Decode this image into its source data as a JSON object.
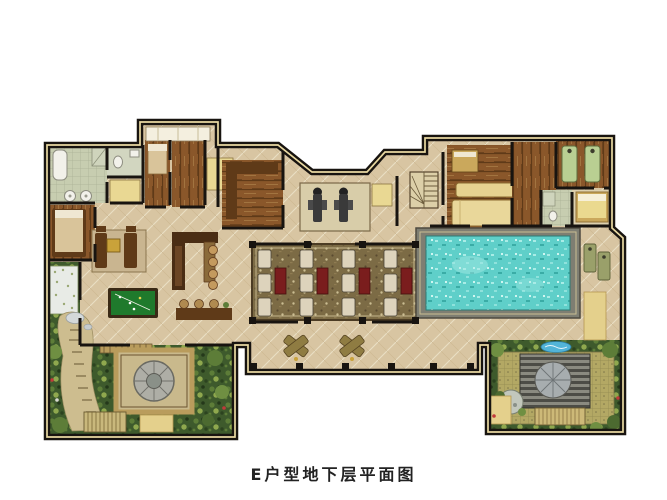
{
  "caption": "E户型地下层平面图",
  "plan": {
    "features": [
      "building-outline",
      "lightwell-notch",
      "bathroom",
      "toilet-room",
      "shower",
      "closet-rooms",
      "bedroom-left",
      "lounge-sofa-set",
      "bar-counter",
      "bar-stools",
      "billiards-table",
      "home-theater",
      "theater-seats",
      "gym-area",
      "gym-equipment",
      "staircase",
      "media-room",
      "corridor-closet",
      "massage-room",
      "massage-beds",
      "guest-bedroom",
      "guest-bathroom",
      "swimming-pool",
      "pool-deck",
      "pool-loungers",
      "terrace",
      "terrace-loungers",
      "columns",
      "sunken-garden-left",
      "flower-bed",
      "garden-path",
      "fountain-pavilion",
      "garden-steps",
      "sunken-garden-right",
      "garden-deck",
      "water-feature",
      "stone-circle",
      "garden-bench"
    ]
  },
  "colors": {
    "background": "#ffffff",
    "wall": "#181410",
    "wall_trim": "#e9d9a2",
    "floor": "#d8c5a2",
    "floor_light": "#e2d4b6",
    "wood": "#8a572a",
    "wood_dark": "#5f3a18",
    "wood_light": "#a87b45",
    "pool_water": "#5fcfc9",
    "pool_water_light": "#a9ece6",
    "pool_water_dark": "#3aaca6",
    "pool_deck": "#7e7e72",
    "billiard_cloth": "#1f7a2c",
    "carpet": "#7c6b45",
    "carpet_dark": "#5a4a30",
    "carpet_light": "#cbbd92",
    "seat_cream": "#ddd3bc",
    "seat_red": "#7a1d1d",
    "garden_dark": "#3e5a2c",
    "garden_mid": "#5d7d38",
    "garden_light": "#8fa84e",
    "path": "#cdbd8f",
    "stone": "#a8a8a0",
    "tile": "#c7cdb0",
    "mat_yellow": "#e4d08c",
    "massage_green": "#b9cf92",
    "caption_text": "#222222"
  }
}
